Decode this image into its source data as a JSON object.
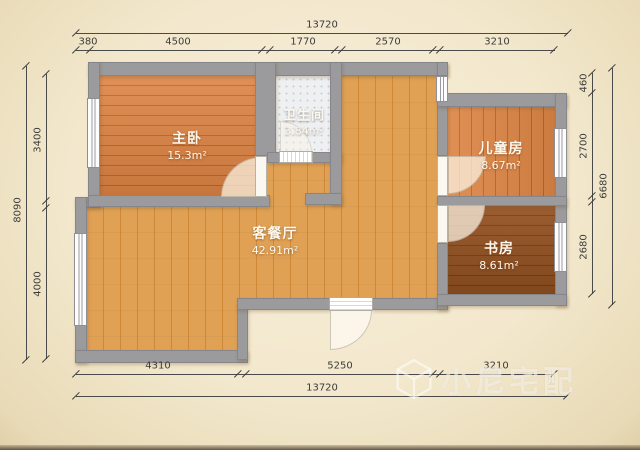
{
  "watermark": {
    "brand": "小尼宅配"
  },
  "rooms": {
    "master": {
      "name": "主卧",
      "area": "15.3m²"
    },
    "bath": {
      "name": "卫生间",
      "area": "3.84m²"
    },
    "kids": {
      "name": "儿童房",
      "area": "8.67m²"
    },
    "study": {
      "name": "书房",
      "area": "8.61m²"
    },
    "living": {
      "name": "客餐厅",
      "area": "42.91m²"
    }
  },
  "dimensions": {
    "top": {
      "total": "13720",
      "seg1": "380",
      "seg2": "4500",
      "seg3": "1770",
      "seg4": "2570",
      "seg5": "3210"
    },
    "bottom": {
      "total": "13720",
      "seg1": "4310",
      "seg2": "5250",
      "seg3": "3210"
    },
    "left": {
      "total": "8090",
      "seg1": "3400",
      "seg2": "4000"
    },
    "right": {
      "total": "6680",
      "seg1": "460",
      "seg2": "2700",
      "seg3": "2680"
    }
  },
  "colors": {
    "paper": "#f3e8cd",
    "wall": "#9b9b9d",
    "floor_master": "#d97f3e",
    "floor_living": "#dd9d4e",
    "floor_kids": "#d57b3a",
    "floor_study": "#87471a",
    "floor_bath": "#eef0f1"
  }
}
